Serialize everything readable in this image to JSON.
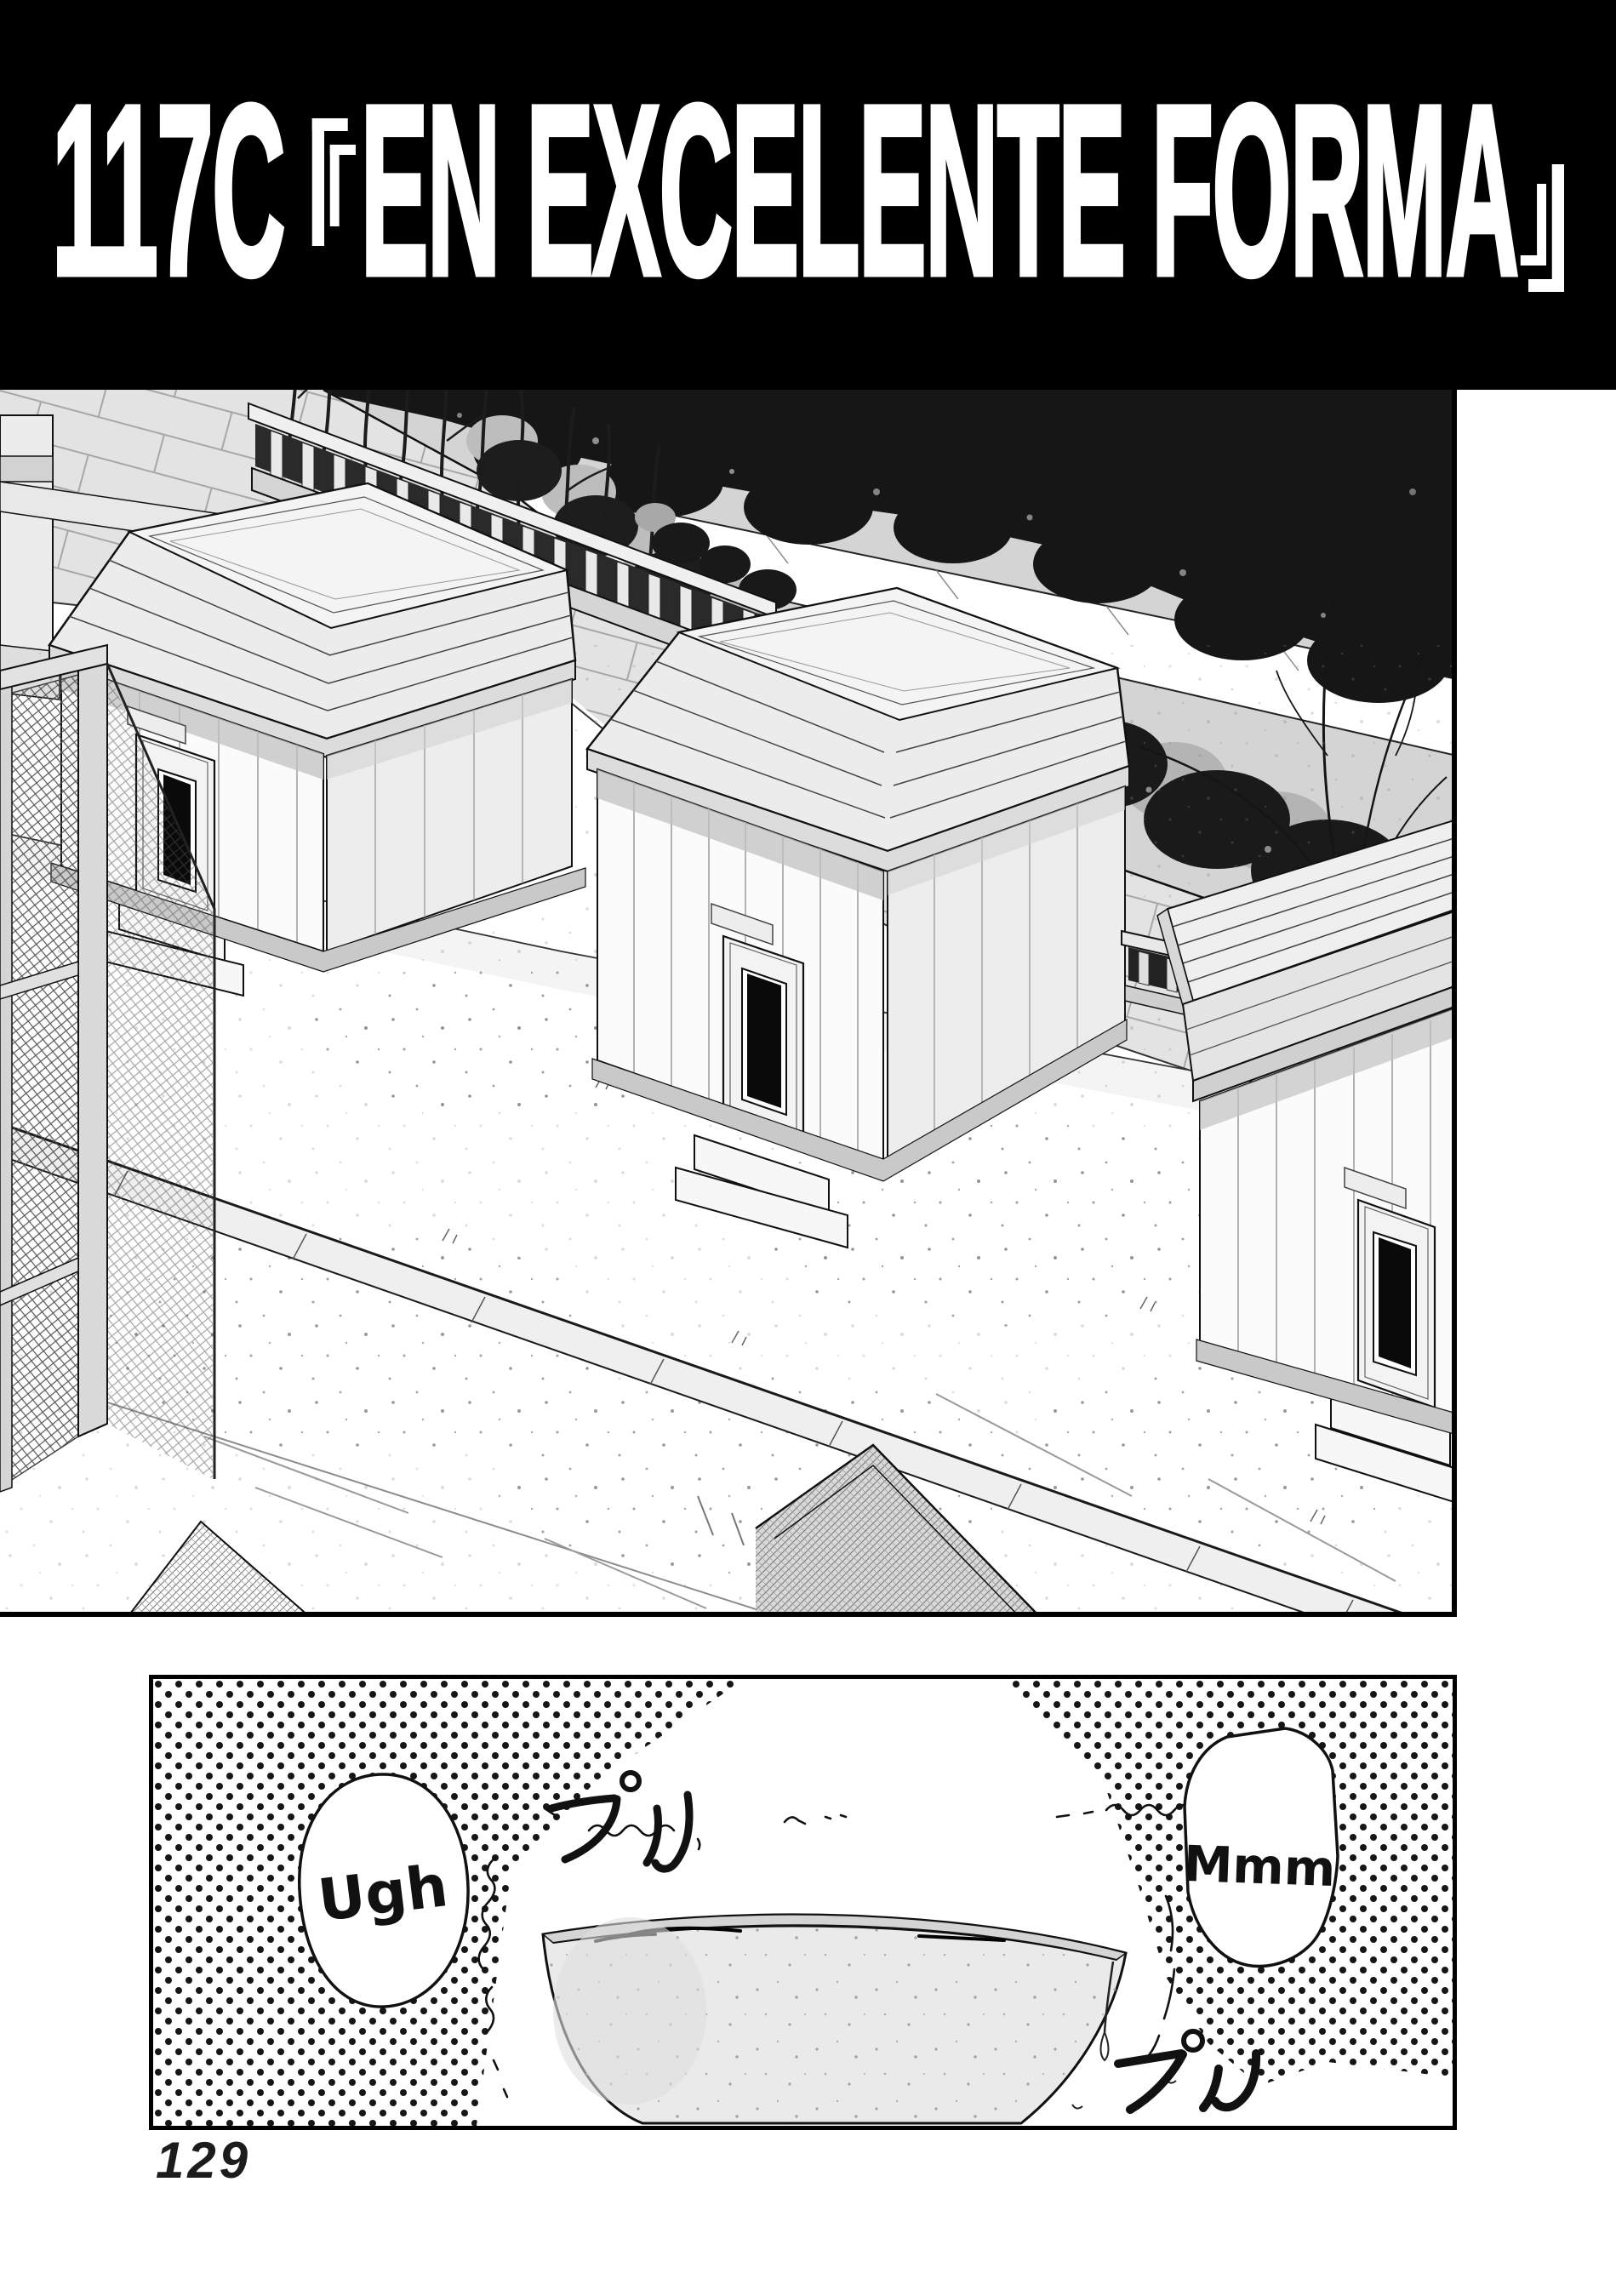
{
  "banner": {
    "chapter": "117C",
    "open_bracket": "『",
    "title": "EN EXCELENTE FORMA",
    "close_bracket": "』",
    "full_title": "117C 『EN EXCELENTE FORMA』"
  },
  "bottom_panel": {
    "bubble_left": "Ugh",
    "bubble_right": "Mmm",
    "sfx_top": "プル",
    "sfx_bottom": "プル"
  },
  "page": {
    "number": "129"
  },
  "colors": {
    "ink": "#000000",
    "paper": "#ffffff",
    "banner_bg": "#000000",
    "banner_text": "#ffffff",
    "tone_light": "#d4d4d4",
    "halftone_dot": "#161616"
  }
}
